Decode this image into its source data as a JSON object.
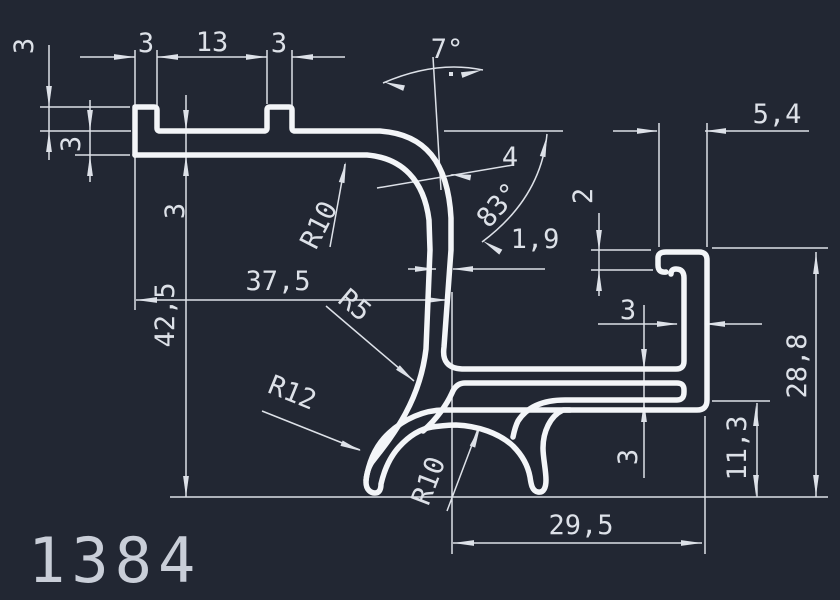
{
  "colors": {
    "background": "#222733",
    "line": "#f3f5f8",
    "dim_text": "#dde1e8",
    "title_text": "#c9ced8"
  },
  "drawing": {
    "profile_number": "1384"
  },
  "dims": {
    "tab1_width": "3",
    "tab_gap": "13",
    "tab2_width": "3",
    "tab_height": "3",
    "flange_thickness": "3",
    "notch_depth": "3",
    "overall_height": "42,5",
    "top_width": "37,5",
    "bend_radius": "R10",
    "tilt_angle": "7°",
    "wall_top_thickness": "4",
    "wall_angle": "83°",
    "wall_thickness": "1,9",
    "lip_depth": "2",
    "hook_width": "5,4",
    "hook_wall": "3",
    "right_height": "28,8",
    "leg_height": "11,3",
    "shelf_gap": "3",
    "bottom_width": "29,5",
    "fillet_radius": "R5",
    "leg_radius": "R12",
    "arch_radius": "R10"
  }
}
